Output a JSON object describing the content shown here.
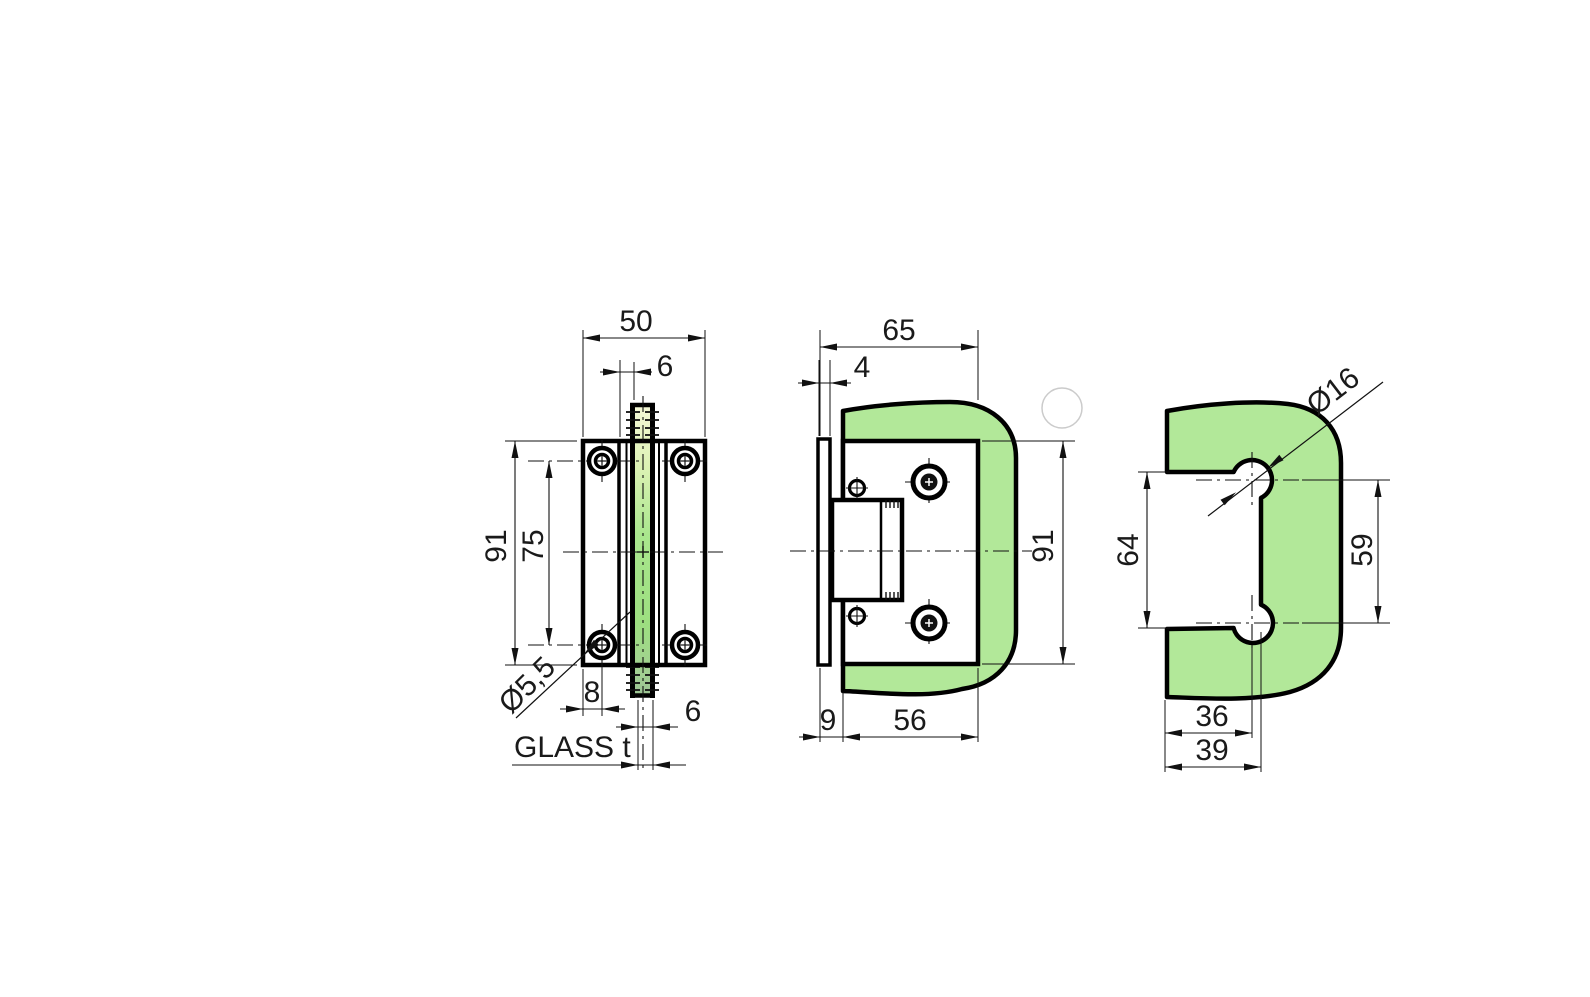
{
  "drawing": {
    "type": "technical-drawing",
    "subject": "glass door hinge with mounting plate and glass cutout template",
    "glass_color": "#b2e899",
    "line_color": "#111111",
    "watermark_color": "#cbcbcb",
    "views": {
      "front": {
        "name": "front-view",
        "dims": {
          "overall_width": "50",
          "pivot_offset": "6",
          "overall_height": "91",
          "hole_spacing": "75",
          "screw_hole_dia": "Ø5,5",
          "edge_to_hole": "8",
          "glass_gap": "6",
          "glass_thickness_label": "GLASS t"
        }
      },
      "side": {
        "name": "side-view",
        "dims": {
          "overall_width": "65",
          "wall_plate_thickness": "4",
          "overall_height": "91",
          "glass_offset": "9",
          "body_width": "56"
        }
      },
      "cutout": {
        "name": "glass-cutout-view",
        "dims": {
          "hole_dia": "Ø16",
          "notch_height": "64",
          "hole_spacing": "59",
          "hole_center_offset": "36",
          "notch_depth": "39"
        }
      }
    }
  }
}
